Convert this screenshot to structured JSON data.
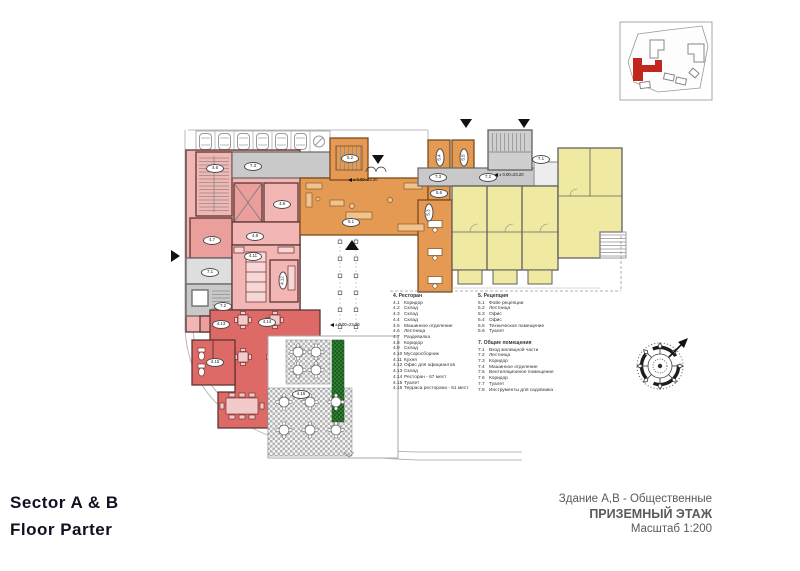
{
  "title_block": {
    "sector": "Sector  A & B",
    "floor": "Floor  Parter"
  },
  "drawing_info": {
    "line1": "Здание А,В - Общественные",
    "line2": "ПРИЗЕМНЫЙ ЭТАЖ",
    "line3": "Масштаб 1:200"
  },
  "legend": {
    "restaurant": {
      "heading": "4. Ресторан",
      "items": [
        {
          "n": "4.1",
          "t": "Коридор"
        },
        {
          "n": "4.2",
          "t": "Склад"
        },
        {
          "n": "4.3",
          "t": "Склад"
        },
        {
          "n": "4.4",
          "t": "Склад"
        },
        {
          "n": "4.5",
          "t": "Машинное отделение"
        },
        {
          "n": "4.6",
          "t": "Лестница"
        },
        {
          "n": "4.7",
          "t": "Раздевалка"
        },
        {
          "n": "4.8",
          "t": "Коридор"
        },
        {
          "n": "4.9",
          "t": "Склад"
        },
        {
          "n": "4.10",
          "t": "Мусоросборник"
        },
        {
          "n": "4.11",
          "t": "Кухня"
        },
        {
          "n": "4.12",
          "t": "Офис для официантов"
        },
        {
          "n": "4.13",
          "t": "Склад"
        },
        {
          "n": "4.14",
          "t": "Ресторан - 67 мест"
        },
        {
          "n": "4.15",
          "t": "Туалет"
        },
        {
          "n": "4.16",
          "t": "Терраса ресторана - 51 мест"
        }
      ]
    },
    "reception": {
      "heading": "5. Рецепция",
      "items": [
        {
          "n": "5.1",
          "t": "Фойе рецепции"
        },
        {
          "n": "5.2",
          "t": "Лестница"
        },
        {
          "n": "5.3",
          "t": "Офис"
        },
        {
          "n": "5.4",
          "t": "Офис"
        },
        {
          "n": "5.5",
          "t": "Техническое помещение"
        },
        {
          "n": "5.6",
          "t": "Туалет"
        }
      ]
    },
    "common": {
      "heading": "7. Общие помещения",
      "items": [
        {
          "n": "7.1",
          "t": "Вход жилищной части"
        },
        {
          "n": "7.2",
          "t": "Лестница"
        },
        {
          "n": "7.3",
          "t": "Коридор"
        },
        {
          "n": "7.4",
          "t": "Машинное отделение"
        },
        {
          "n": "7.5",
          "t": "Вентиляционное помещение"
        },
        {
          "n": "7.6",
          "t": "Коридор"
        },
        {
          "n": "7.7",
          "t": "Туалет"
        },
        {
          "n": "7.8",
          "t": "Инструменты для садовника"
        }
      ]
    }
  },
  "plan": {
    "level_mark": "± 0.00=23.20",
    "room_labels": {
      "r4_6": "4.6",
      "r4_7": "4.7",
      "r4_8": "4.8",
      "r4_9": "4.9",
      "r4_11": "4.11",
      "r4_12": "4.12",
      "r4_13": "4.13",
      "r4_14": "4.14",
      "r4_15": "4.15",
      "r4_16": "4.16",
      "r5_1": "5.1",
      "r5_2": "5.2",
      "r5_3": "5.3",
      "r5_4": "5.4",
      "r5_5": "5.5",
      "r5_6": "5.6",
      "r7_1_left": "7.1",
      "r7_2_left": "7.2",
      "r7_3_left": "7.3",
      "r7_1_right": "7.1",
      "r7_2_mid": "7.2",
      "r7_3_mid": "7.3"
    }
  },
  "colors": {
    "restaurant_pink": "#f2b7b4",
    "restaurant_red": "#dd6a66",
    "reception_orange": "#e49a52",
    "residential_yellow": "#efe9a1",
    "corridor_gray": "#c9c9c9",
    "hedge_green": "#2e7d32",
    "site_highlight_red": "#c1271d"
  }
}
